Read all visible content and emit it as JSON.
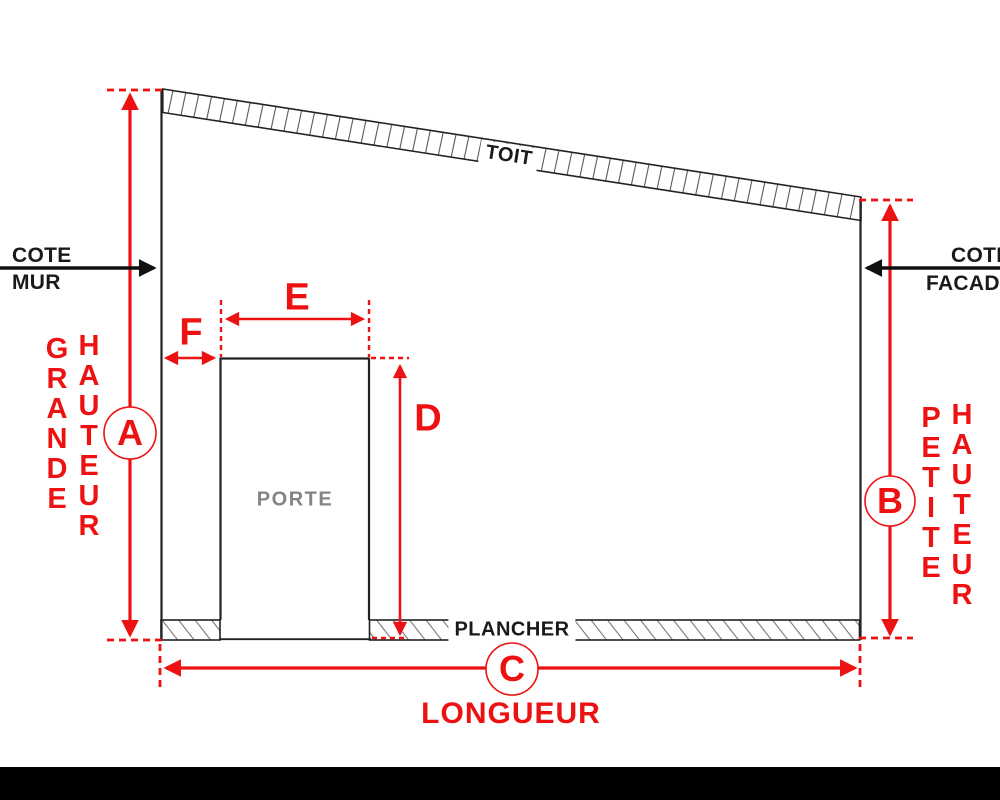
{
  "colors": {
    "accent_red": "#ee1111",
    "ink_black": "#1a1a1a",
    "door_gray": "#848484"
  },
  "structure": {
    "roof_label": "TOIT",
    "floor_label": "PLANCHER",
    "door_label": "PORTE"
  },
  "callouts": {
    "wall": {
      "line1": "COTE",
      "line2": "MUR"
    },
    "facade": {
      "line1": "COTE",
      "line2": "FACADE"
    }
  },
  "dims": {
    "A": {
      "letter": "A",
      "word1": "GRANDE",
      "word2": "HAUTEUR"
    },
    "B": {
      "letter": "B",
      "word1": "PETITE",
      "word2": "HAUTEUR"
    },
    "C": {
      "letter": "C",
      "word": "LONGUEUR"
    },
    "D": {
      "letter": "D"
    },
    "E": {
      "letter": "E"
    },
    "F": {
      "letter": "F"
    }
  }
}
